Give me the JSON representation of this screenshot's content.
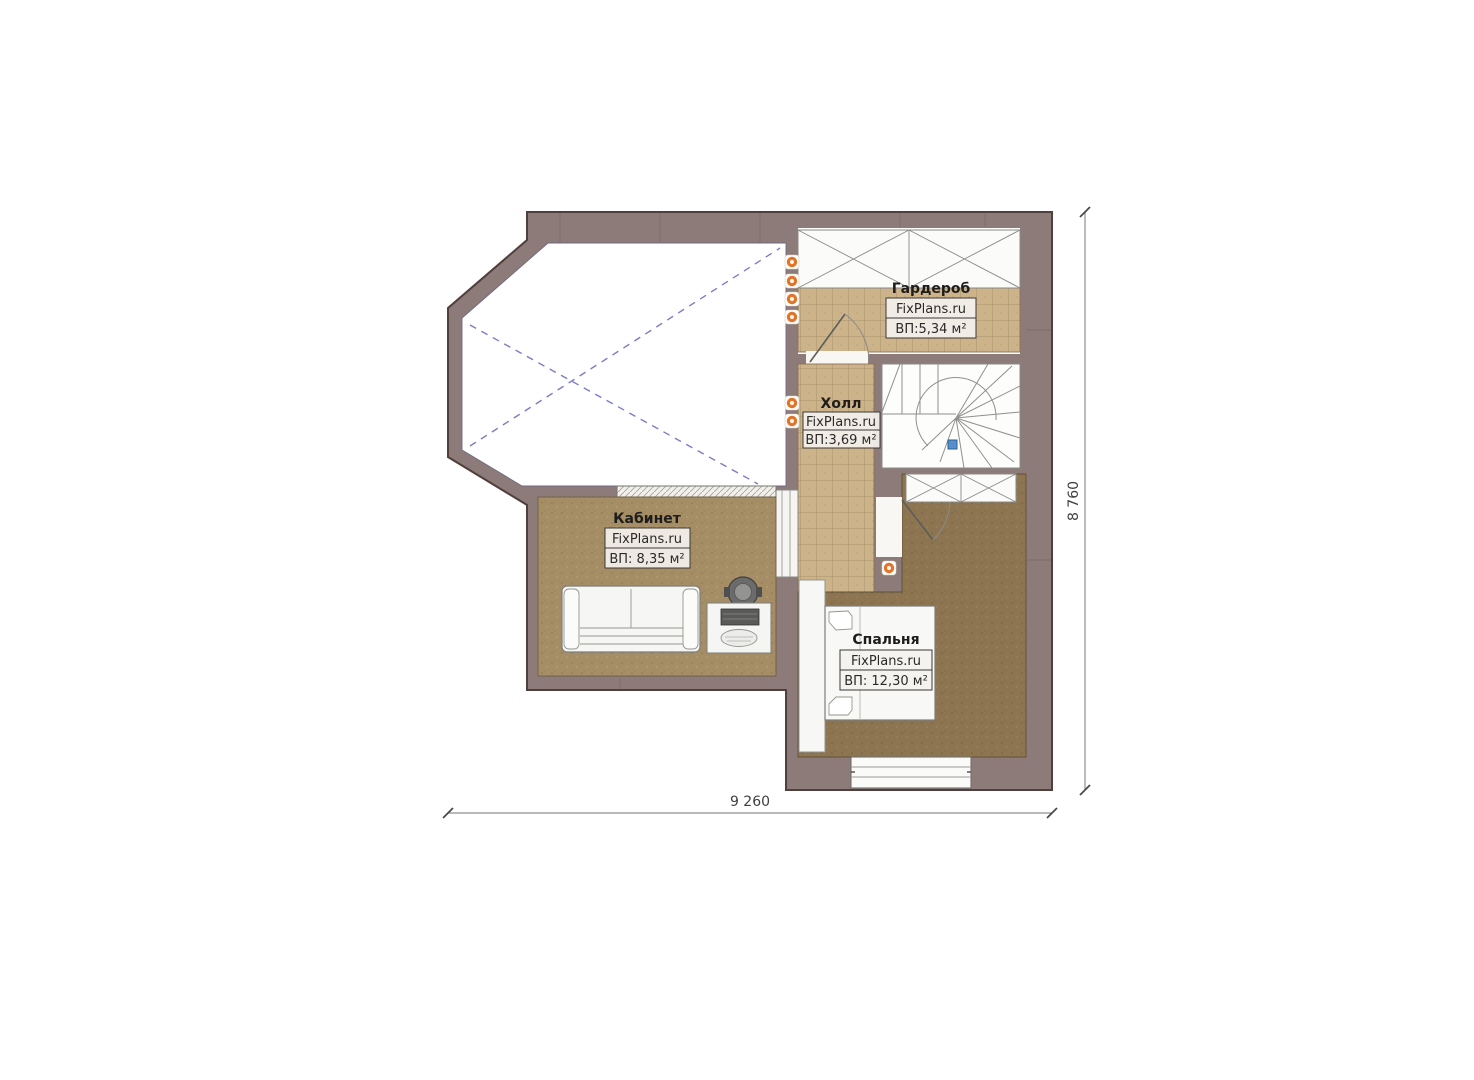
{
  "rooms": [
    {
      "name": "Гардероб",
      "site": "FixPlans.ru",
      "area": "ВП:5,34 м²"
    },
    {
      "name": "Холл",
      "site": "FixPlans.ru",
      "area": "ВП:3,69 м²"
    },
    {
      "name": "Кабинет",
      "site": "FixPlans.ru",
      "area": "ВП: 8,35 м²"
    },
    {
      "name": "Спальня",
      "site": "FixPlans.ru",
      "area": "ВП: 12,30 м²"
    }
  ],
  "dimensions": {
    "width": "9 260",
    "height": "8 760"
  },
  "colors": {
    "wall": "#8d7b79",
    "wall_outline": "#503f3c",
    "tile_floor": "#ccb38a",
    "office_floor": "#a58e66",
    "bedroom_floor": "#8c7550",
    "void_cross": "#7c7cc8",
    "light_dot": "#e2742a",
    "label_text": "#222222"
  }
}
